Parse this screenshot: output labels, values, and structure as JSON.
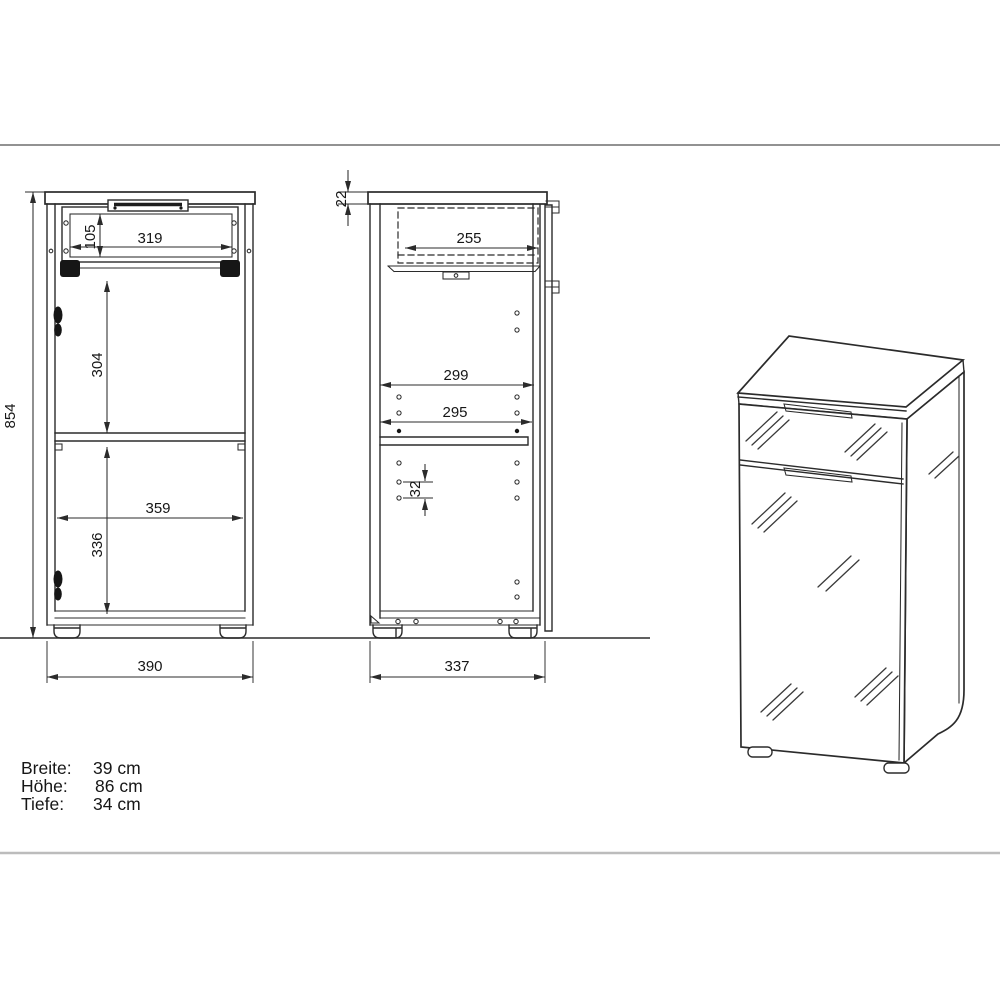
{
  "drawing": {
    "front_view": {
      "dimensions": {
        "overall_height": "854",
        "drawer_inner_height": "105",
        "drawer_inner_width": "319",
        "upper_compartment_height": "304",
        "inner_width": "359",
        "lower_compartment_height": "336",
        "overall_width": "390"
      }
    },
    "side_view": {
      "dimensions": {
        "top_panel_thickness": "22",
        "drawer_depth": "255",
        "inner_depth_upper": "299",
        "inner_depth_lower": "295",
        "hole_pitch": "32",
        "overall_depth": "337"
      }
    }
  },
  "specs": {
    "rows": [
      {
        "label": "Breite:",
        "value": "39 cm"
      },
      {
        "label": "Höhe:",
        "value": "86 cm"
      },
      {
        "label": "Tiefe:",
        "value": "34 cm"
      }
    ]
  },
  "colors": {
    "line": "#2b2b2b",
    "top_rule": "#6f6f6f",
    "bottom_rule": "#bcbcbc",
    "background": "#ffffff"
  }
}
